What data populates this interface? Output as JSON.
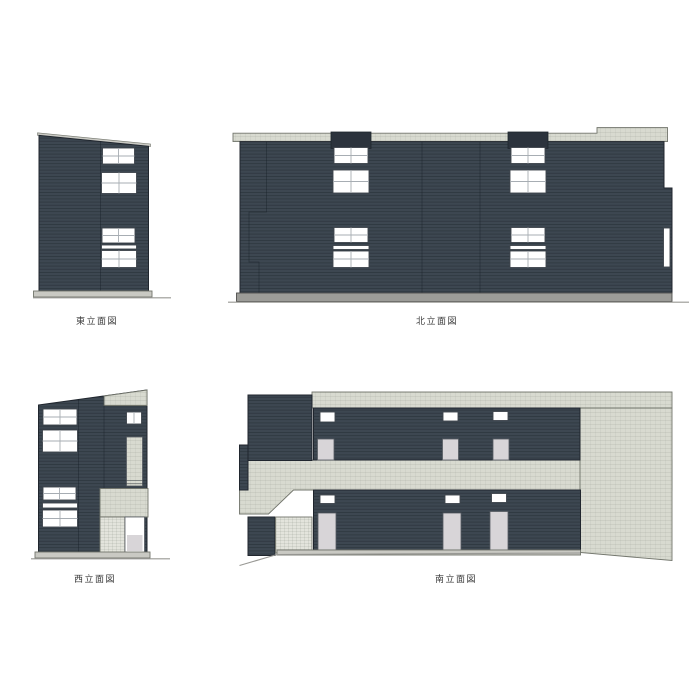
{
  "page": {
    "background": "#ffffff",
    "drawing_type": "building elevations"
  },
  "elevations": {
    "east": {
      "label": "東立面図"
    },
    "north": {
      "label": "北立面図"
    },
    "west": {
      "label": "西立面図"
    },
    "south": {
      "label": "南立面図"
    }
  },
  "colors": {
    "facade_dark": "#3d4751",
    "facade_darker": "#2c333d",
    "trim_light": "#d8dad0",
    "porch_light": "#e3e4dc",
    "window_white": "#ffffff",
    "window_frame": "#3f454d",
    "mullion": "#a7adb3",
    "door_gray": "#d8d5d8",
    "door_frame": "#575c63",
    "base_gray": "#c9c9c3",
    "base_dark_gray": "#9c9c98",
    "ground_line": "#989894",
    "outline_dark": "#20262e",
    "outline_light": "#72756c",
    "label_text": "#3a3a3a"
  }
}
